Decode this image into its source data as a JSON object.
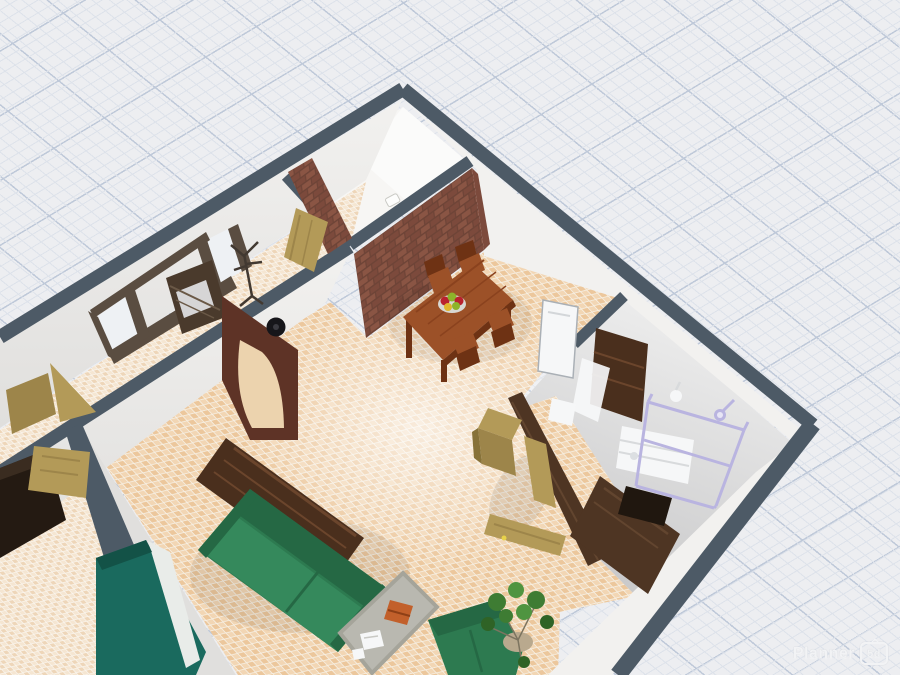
{
  "app": {
    "watermark_brand": "Planner",
    "watermark_badge": "5d"
  },
  "colors": {
    "bg": "#edeef1",
    "grid_minor": "#dde2ea",
    "grid_major": "#bfc9d9",
    "wall_top": "#4d5a66",
    "wall_face": "#f2f1ef",
    "wall_face_shade": "#e0dfdd",
    "wall_face_dark": "#cfcfce",
    "floor_white": "#f7f6f4",
    "tile_grout": "#f7f1e6",
    "tile_a": "#ecc79c",
    "tile_b": "#f2d6b4",
    "tile_pale_grout": "#fbf7f0",
    "tile_pale_a": "#eed6b9",
    "tile_pale_b": "#f5e6d2",
    "bath_floor_light": "#ececec",
    "bath_floor_dark": "#c9c9ca",
    "brick_mortar": "#6e4437",
    "brick_a": "#8a5544",
    "brick_b": "#7c4a3c",
    "wood_table": "#9c5128",
    "wood_table_dark": "#6e3214",
    "wood_dark": "#4a2f1d",
    "wood_streak": "#6b452c",
    "wood_wall": "#4e3523",
    "wood_tan": "#b39a58",
    "wood_tan_dark": "#9d854a",
    "arch_wood": "#5e3326",
    "near_black": "#241a12",
    "door_frame": "#5a4d41",
    "door_leaf": "#4a3a2c",
    "glass": "#eef1f4",
    "sofa": "#2d7a50",
    "sofa_dark": "#256844",
    "sofa_light": "#35895c",
    "teal": "#1a6a5e",
    "mattress_white": "#e9ece9",
    "rug": "#b9b8b0",
    "item_orange": "#c2602b",
    "white_obj": "#f6f7f8",
    "lavender": "#b9b4e0",
    "plant": "#3e7c33",
    "plant_dark": "#2f6326",
    "plant_light": "#4f9440",
    "pot": "#b9a98e",
    "clock_black": "#16161a",
    "fruit_red": "#b9212e",
    "fruit_green": "#8db32a",
    "fruit_yellow": "#e0b52c",
    "bowl": "#d8d8d3",
    "watermark": "#f2f3f5"
  },
  "scene": {
    "view": "3d-floorplan-perspective",
    "rooms": [
      {
        "name": "storage-room",
        "contents": [
          "wall-switch"
        ]
      },
      {
        "name": "hallway",
        "contents": [
          "entrance-door-unit",
          "coat-rack",
          "arched-doorway",
          "wall-clock",
          "open-door-wedges"
        ]
      },
      {
        "name": "dining-area",
        "contents": [
          "brick-wall",
          "dining-table",
          "chair",
          "chair",
          "chair",
          "chair",
          "fruit-bowl"
        ]
      },
      {
        "name": "living-room",
        "contents": [
          "sideboard",
          "green-sofa",
          "rug",
          "orange-book",
          "magazines",
          "green-armchair",
          "potted-plant",
          "tall-cabinet",
          "open-tan-door"
        ]
      },
      {
        "name": "bedroom",
        "contents": [
          "wardrobe",
          "flat-tan-door",
          "teal-bed"
        ]
      },
      {
        "name": "bathroom",
        "contents": [
          "white-door",
          "shelf-unit",
          "towel-drape",
          "washing-machine",
          "toilet",
          "dark-vanity",
          "wood-counter",
          "shower-frame",
          "shower-head",
          "wall-sconce"
        ]
      }
    ]
  }
}
